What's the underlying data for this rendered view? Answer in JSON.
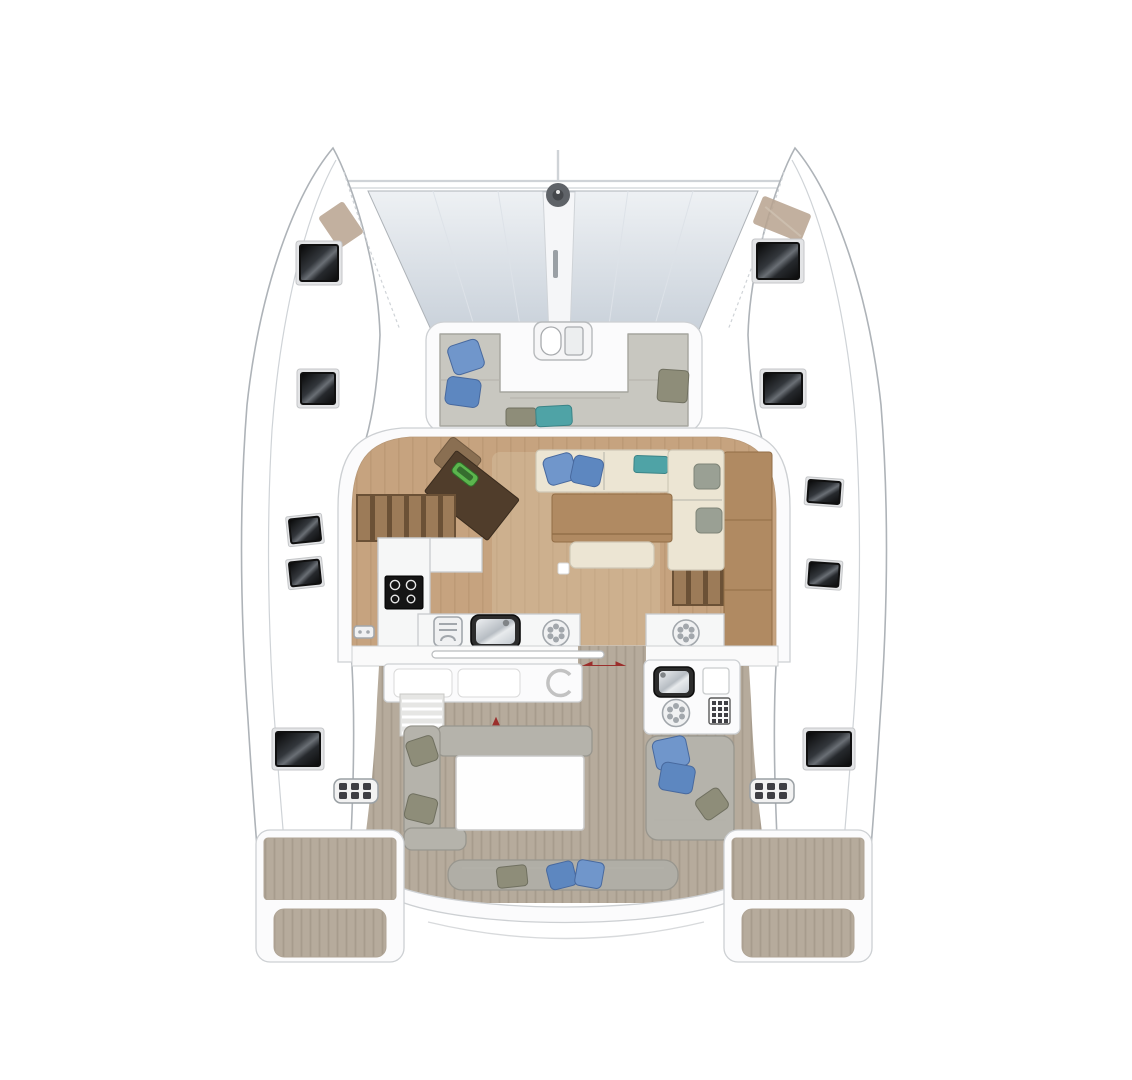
{
  "title": "catamaran-deck-floor-plan",
  "colors": {
    "bg": "#ffffff",
    "hull-fill": "#ffffff",
    "hull-stroke": "#aeb3b8",
    "line-light": "#cfd3d7",
    "tramp-light": "#eef1f4",
    "tramp-dark": "#c9d1da",
    "walkway": "#f5f6f8",
    "windlass": "#5f6368",
    "windlass-ring": "#45484c",
    "white-panel": "#fbfbfc",
    "panel-stroke": "#cdd0d3",
    "sofa-gray": "#c8c7c0",
    "sofa-gray-dark": "#a5a59e",
    "cockpit-sofa": "#b5b3ab",
    "cockpit-sofa-dark": "#98968e",
    "bench-gray": "#b0aea6",
    "cream": "#ece5d3",
    "cream-stroke": "#cfc8b6",
    "pillow-blue": "#7096cb",
    "pillow-blue-dark": "#5d87c0",
    "pillow-blue-edge": "#48699e",
    "pillow-teal": "#4fa3a6",
    "pillow-teal-edge": "#3b8487",
    "pillow-olive": "#8e8d79",
    "pillow-olive-edge": "#707060",
    "wood-floor": "#c6a37f",
    "wood-stripe": "#b6926f",
    "wood-mid": "#b08a62",
    "wood-mid-edge": "#926e47",
    "wood-dark": "#503d2b",
    "wood-stairs": "#9c7b58",
    "stairs-gap": "#6b5136",
    "teak-base": "#b6ab9c",
    "teak-stripe": "#a79c8d",
    "deck-tan": "#b7a28e",
    "counter-white": "#f6f7f7",
    "counter-stroke": "#c8cbcd",
    "appliance-dark": "#2c2c2c",
    "steel-light": "#eef0f2",
    "steel-dark": "#b7bdc3",
    "icon-fill": "#f0f1f2",
    "icon-stroke": "#a2a7ac",
    "seat-line": "#b3b2aa",
    "hatch-frame": "#e3e4e6",
    "hatch-dark": "#101010",
    "hatch-sheen": "#6a6f75",
    "radio-green": "#5cb54e",
    "red-arrow": "#9b2f2c",
    "button-dark": "#3f3f44"
  },
  "features": {
    "bow": [
      "trampoline",
      "bow-walkway",
      "windlass",
      "forward-crossbeam",
      "bow-deck-pads"
    ],
    "forward_cockpit": [
      "u-shaped-sofa",
      "blue-pillows",
      "teal-cushion",
      "olive-cushions",
      "salon-front-door"
    ],
    "salon": [
      "nav-station",
      "nav-instrument",
      "port-stairs",
      "starboard-stairs",
      "galley-cooktop",
      "galley-sink",
      "galley-vent-burner",
      "galley-appliance",
      "dining-table",
      "salon-sofa",
      "salon-chaise",
      "sideboard",
      "vent-fitting"
    ],
    "aft_cockpit": [
      "sliding-door",
      "door-direction-arrows",
      "storage-bench",
      "life-ring",
      "port-steps",
      "l-shaped-sofa",
      "cockpit-table",
      "outdoor-galley-sink",
      "outdoor-burner",
      "icebox-keypad",
      "starboard-bench",
      "aft-bench"
    ],
    "stern": [
      "transom-beam",
      "swim-platform-port",
      "swim-platform-starboard"
    ],
    "deck": [
      "deck-hatch-x8",
      "engine-control-panel-x2",
      "side-decks"
    ]
  }
}
